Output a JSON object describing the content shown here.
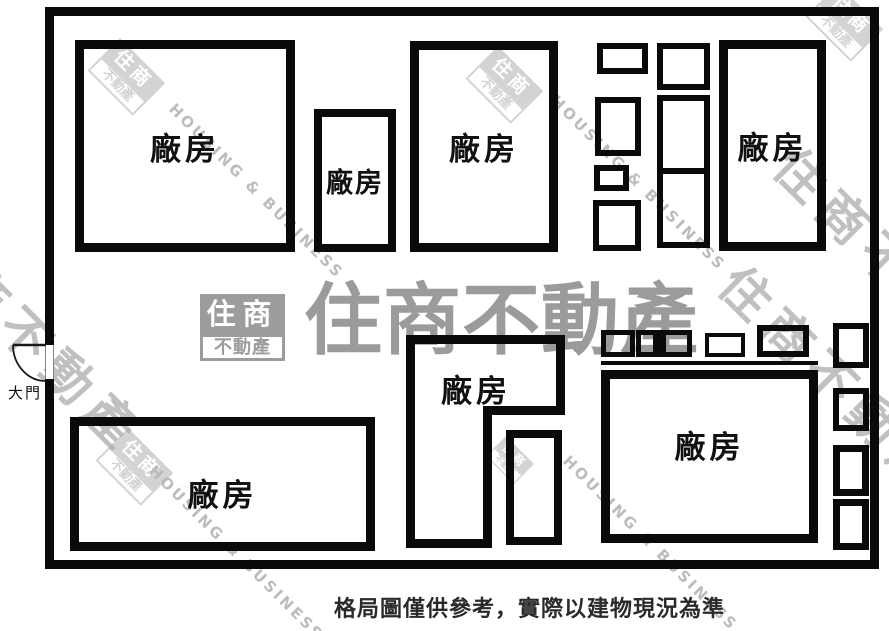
{
  "caption": "格局圖僅供參考，實際以建物現況為準",
  "door": {
    "label": "大門"
  },
  "rooms": [
    {
      "id": "top-left",
      "label": "廠房"
    },
    {
      "id": "top-small",
      "label": "廠房"
    },
    {
      "id": "top-middle",
      "label": "廠房"
    },
    {
      "id": "top-right",
      "label": "廠房"
    },
    {
      "id": "bottom-left",
      "label": "廠房"
    },
    {
      "id": "bottom-middle",
      "label": "廠房"
    },
    {
      "id": "bottom-right",
      "label": "廠房"
    }
  ],
  "watermark": {
    "brand_zh_top": "住商",
    "brand_zh_bottom": "不動產",
    "brand_full": "住商不動產",
    "brand_en": "HOUSING & BUSINESS",
    "gray": "#9c9c9c"
  },
  "colors": {
    "wall": "#0a0a0a",
    "label": "#111111",
    "caption": "#2a2a2a",
    "background": "#ffffff"
  }
}
